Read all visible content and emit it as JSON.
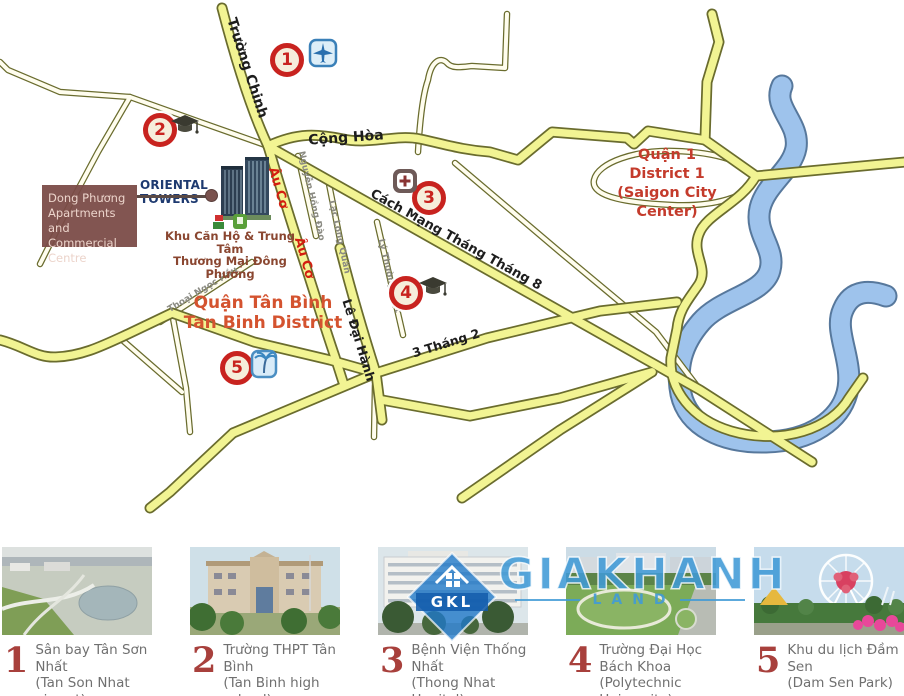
{
  "map": {
    "project": {
      "label": "ORIENTAL TOWERS",
      "box_line1": "Dong Phương",
      "box_line2": "Apartments  and",
      "box_line3": "Commercial Centre",
      "caption_line1": "Khu Căn Hộ & Trung Tâm",
      "caption_line2": "Thương Mại Đông Phương"
    },
    "district1": {
      "line1": "Quận 1",
      "line2": "District 1",
      "line3": "(Saigon City Center)"
    },
    "tan_binh": {
      "line1": "Quận Tân Bình",
      "line2": "Tan Binh District"
    },
    "roads": {
      "truong_chinh": "Trường Chinh",
      "cong_hoa": "Cộng Hòa",
      "cmt8": "Cách Mạng Tháng Tháng 8",
      "au_co_1": "Âu Cơ",
      "au_co_2": "Âu Cơ",
      "le_dai_hanh": "Lê Đại Hành",
      "ba_thang_hai": "3 Tháng 2",
      "nguyen_hong_dao": "Nguyễn Hồng Đào",
      "lac_long_quan": "Lạc Long Quân",
      "ly_thuong_kiet": "Lý Thường Kiệt",
      "thoai_ngoc_hau": "Thoại Ngọc Hầu"
    },
    "markers": {
      "m1": "1",
      "m2": "2",
      "m3": "3",
      "m4": "4",
      "m5": "5"
    }
  },
  "legend": {
    "items": [
      {
        "number": "1",
        "title": "Sân bay Tân Sơn Nhất",
        "subtitle": "(Tan Son Nhat airport)"
      },
      {
        "number": "2",
        "title": "Trường THPT Tân Bình",
        "subtitle": "(Tan Binh high school)"
      },
      {
        "number": "3",
        "title": "Bệnh Viện Thống Nhất",
        "subtitle": "(Thong Nhat Hopital)"
      },
      {
        "number": "4",
        "title": "Trường Đại Học Bách Khoa",
        "subtitle": "(Polytechnic University)"
      },
      {
        "number": "5",
        "title": "Khu du lịch  Đầm Sen",
        "subtitle": "(Dam Sen Park)"
      }
    ]
  },
  "watermark": {
    "brand": "GIAKHANH",
    "sub": "LAND",
    "logo": "GKL"
  },
  "colors": {
    "road_fill": "#f2f493",
    "road_casing": "#6a6c2e",
    "minor_fill": "#fffdee",
    "river_fill": "#9ec3ec",
    "river_casing": "#57789c",
    "marker_red": "#c8231f",
    "district_red": "#c43b2c",
    "tanbinh_orange": "#d4532f",
    "watermark_blue": "#3f9bd8",
    "project_box_brown": "#7a4a46",
    "oriental_navy": "#1e3a70"
  }
}
